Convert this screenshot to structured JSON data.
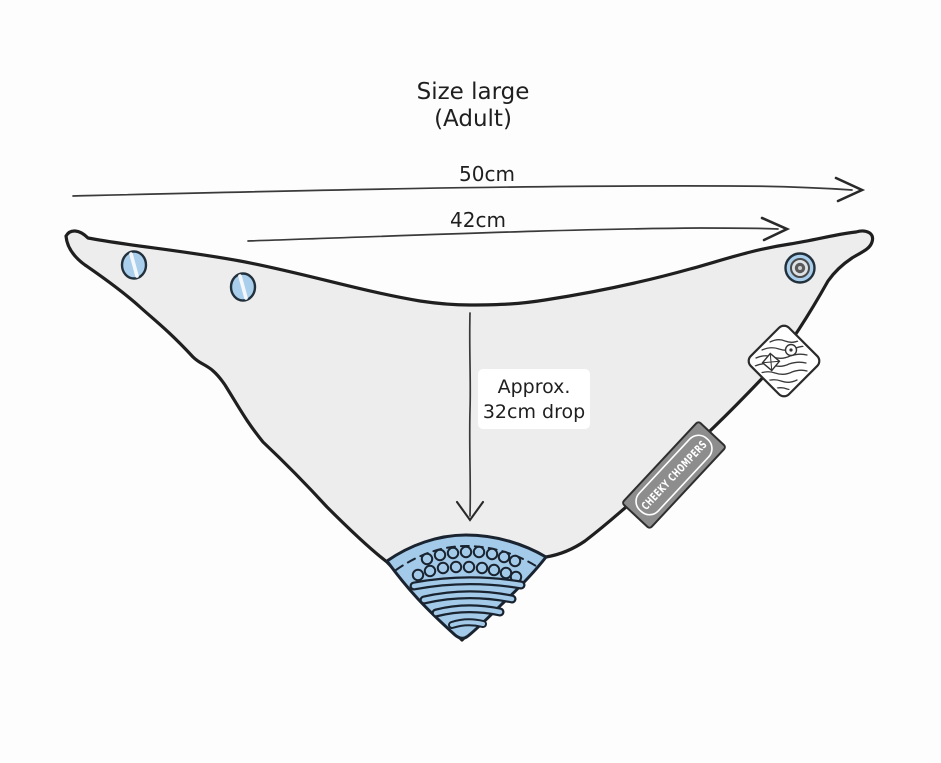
{
  "title": {
    "line1": "Size large",
    "line2": "(Adult)"
  },
  "measurements": {
    "total_width": "50cm",
    "snap_width": "42cm",
    "drop_label_line1": "Approx.",
    "drop_label_line2": "32cm drop"
  },
  "brand_tag": {
    "label": "CHEEKY CHOMPERS"
  },
  "icons": {
    "snap_button": "snap-button-icon",
    "snap_socket": "snap-socket-icon",
    "care_label": "care-label-icon",
    "teether": "teether-corner-icon"
  },
  "colors": {
    "background": "#fdfdfd",
    "fabric": "#ededed",
    "outline": "#1f1f1f",
    "snap_blue": "#a9cfec",
    "teether_blue": "#a3cbe9",
    "teether_outline": "#1a2430",
    "tag_gray": "#8d8d8d",
    "label_white": "#ffffff",
    "text": "#1f1f1f"
  }
}
